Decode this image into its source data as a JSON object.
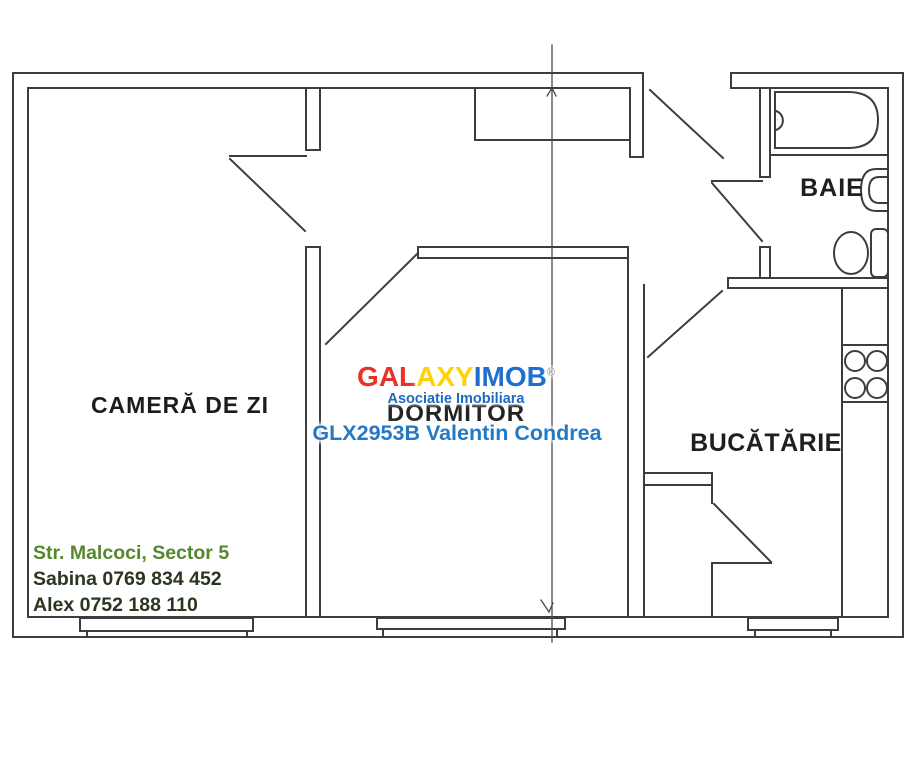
{
  "plan": {
    "rooms": {
      "living": "CAMERĂ DE ZI",
      "bedroom": "DORMITOR",
      "bath": "BAIE",
      "kitchen": "BUCĂTĂRIE"
    },
    "fixtures": [
      "bathtub",
      "sink",
      "toilet",
      "stove-4-burners",
      "wardrobe",
      "windows"
    ],
    "watermark": {
      "brand_part1": "GAL",
      "brand_part2": "AXY",
      "brand_part3": "IMOB",
      "brand_reg": "®",
      "tagline": "Asociatie Imobiliara",
      "agent_line": "GLX2953B Valentin Condrea"
    },
    "contact": {
      "address": "Str. Malcoci, Sector 5",
      "phone1": "Sabina 0769 834 452",
      "phone2": "Alex 0752 188 110"
    },
    "colors": {
      "line": "#3d3d3d",
      "brand_red": "#e8332a",
      "brand_yellow": "#ffd200",
      "brand_blue": "#1f6fd0",
      "tagline_blue": "#1c6bbf",
      "agent_blue": "#2579c4",
      "address_green": "#55872b",
      "phone_dark": "#293620"
    }
  }
}
